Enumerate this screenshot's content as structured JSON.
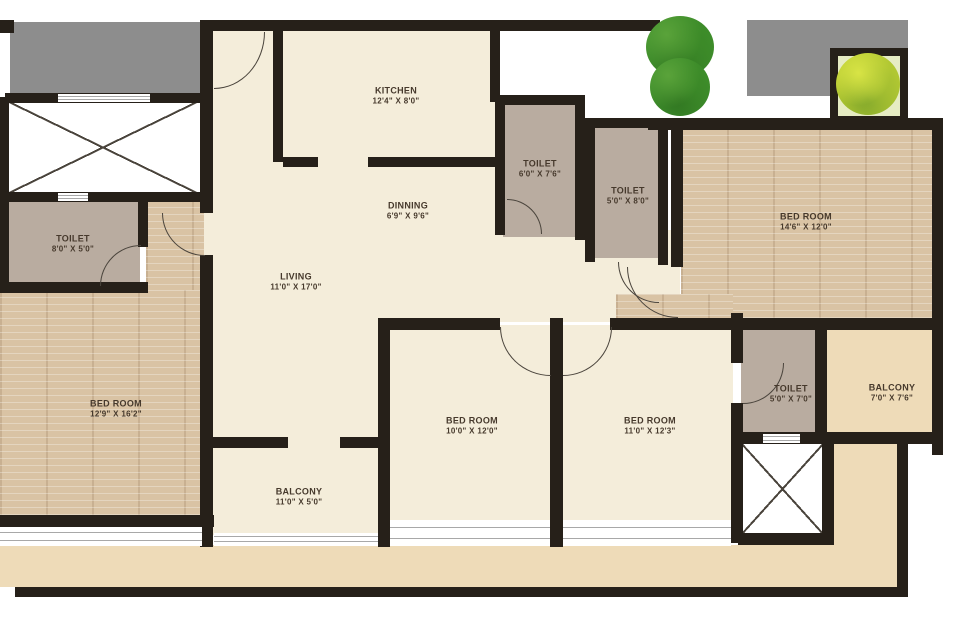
{
  "colors": {
    "wall": "#262019",
    "floor-cream": "#f4edda",
    "floor-toilet": "#b9aca0",
    "floor-wood": "#d9c3a4",
    "floor-balcony": "#eedbb8",
    "slab-gray": "#8d8d8d",
    "tree-dark": "#3f8f2c",
    "tree-light": "#b9cc33",
    "label-ink": "#46392c"
  },
  "rooms": {
    "kitchen": {
      "name": "KITCHEN",
      "dims": "12'4\" X 8'0\""
    },
    "dinning": {
      "name": "DINNING",
      "dims": "6'9\" X 9'6\""
    },
    "living": {
      "name": "LIVING",
      "dims": "11'0\" X 17'0\""
    },
    "toilet_top": {
      "name": "TOILET",
      "dims": "6'0\" X 7'6\""
    },
    "toilet_mid": {
      "name": "TOILET",
      "dims": "5'0\" X 8'0\""
    },
    "toilet_left": {
      "name": "TOILET",
      "dims": "8'0\" X 5'0\""
    },
    "toilet_right": {
      "name": "TOILET",
      "dims": "5'0\" X 7'0\""
    },
    "bedroom_master": {
      "name": "BED ROOM",
      "dims": "14'6\" X 12'0\""
    },
    "bedroom_left": {
      "name": "BED ROOM",
      "dims": "12'9\" X 16'2\""
    },
    "bedroom_mid": {
      "name": "BED ROOM",
      "dims": "10'0\" X 12'0\""
    },
    "bedroom_right2": {
      "name": "BED ROOM",
      "dims": "11'0\" X 12'3\""
    },
    "balcony_bottom": {
      "name": "BALCONY",
      "dims": "11'0\" X 5'0\""
    },
    "balcony_right": {
      "name": "BALCONY",
      "dims": "7'0\" X 7'6\""
    }
  }
}
